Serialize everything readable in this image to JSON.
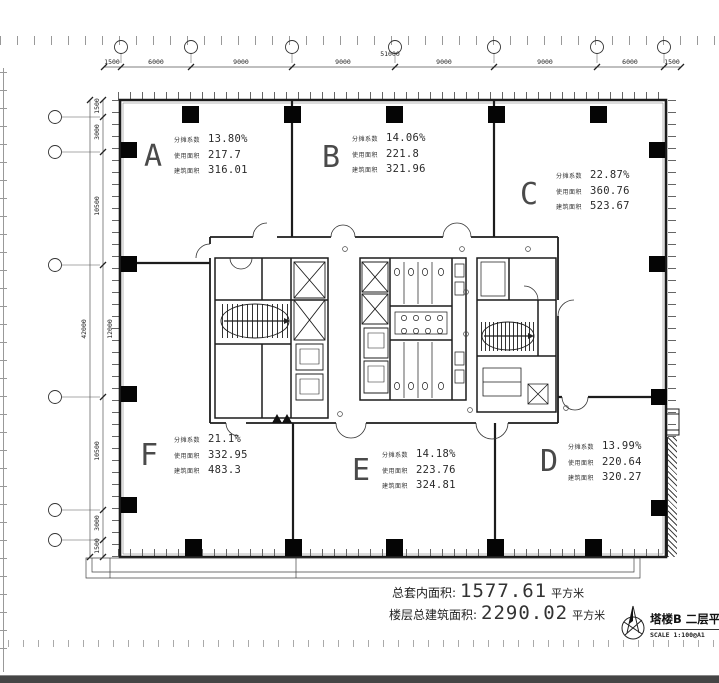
{
  "drawing": {
    "colors": {
      "linework": "#1c1c1c",
      "bottom_band": "#454545"
    },
    "grid": {
      "total_top": "51000",
      "top_dims": [
        "1500",
        "6000",
        "9000",
        "9000",
        "9000",
        "9000",
        "6000",
        "1500"
      ],
      "total_left": "42000",
      "left_dims": [
        "1500",
        "3000",
        "10500",
        "12000",
        "10500",
        "3000",
        "1500"
      ]
    },
    "labels": {
      "coef": "分摊系数",
      "usable": "使用面积",
      "built": "建筑面积"
    },
    "zones": [
      {
        "letter": "A",
        "coef": "13.80%",
        "usable": "217.7",
        "built": "316.01"
      },
      {
        "letter": "B",
        "coef": "14.06%",
        "usable": "221.8",
        "built": "321.96"
      },
      {
        "letter": "C",
        "coef": "22.87%",
        "usable": "360.76",
        "built": "523.67"
      },
      {
        "letter": "F",
        "coef": "21.1%",
        "usable": "332.95",
        "built": "483.3"
      },
      {
        "letter": "E",
        "coef": "14.18%",
        "usable": "223.76",
        "built": "324.81"
      },
      {
        "letter": "D",
        "coef": "13.99%",
        "usable": "220.64",
        "built": "320.27"
      }
    ],
    "summary": {
      "net_label": "总套内面积:",
      "net_value": "1577.61",
      "net_unit": "平方米",
      "gross_label": "楼层总建筑面积:",
      "gross_value": "2290.02",
      "gross_unit": "平方米"
    },
    "titleblock": {
      "title": "塔楼B 二层平面",
      "scale": "SCALE 1:100@A1"
    }
  }
}
